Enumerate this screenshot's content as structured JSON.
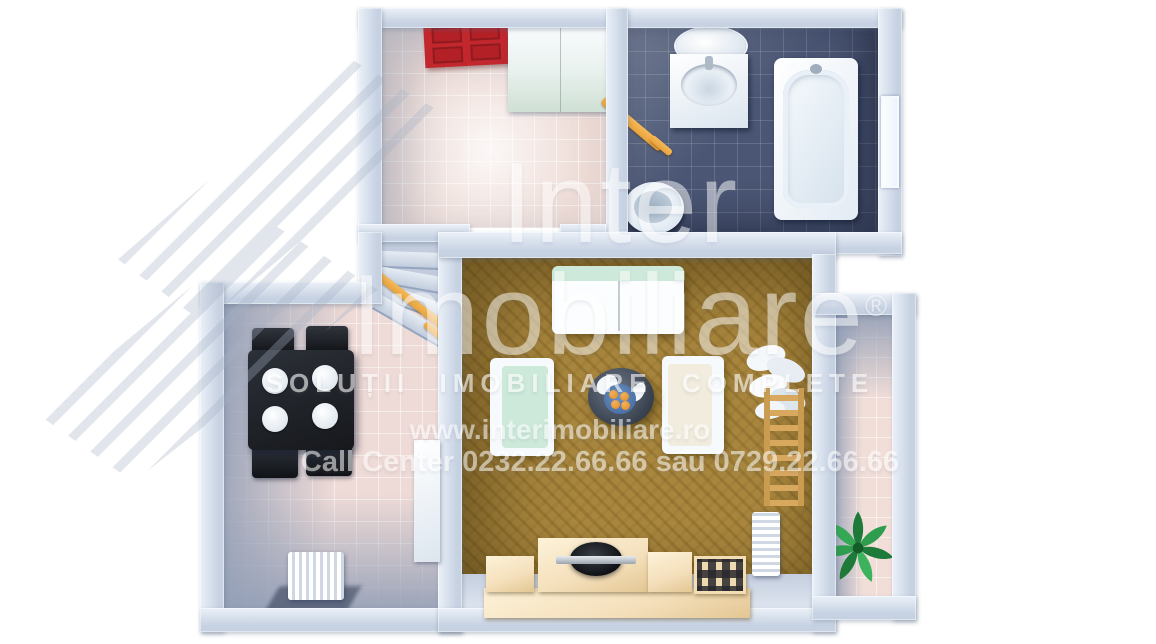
{
  "watermark": {
    "brand_top": "Inter",
    "brand_bottom": "Imobiliare",
    "registered": "®",
    "tagline": "SOLUȚII IMOBILIARE COMPLETE",
    "website": "www.interimobiliare.ro",
    "call_center": "Call Center 0232.22.66.66 sau 0729.22.66.66"
  },
  "colors": {
    "background": "#ffffff",
    "wall": "#c6d1e2",
    "wall_light": "#ebf1f8",
    "wall_shadow": "#93a5c0",
    "entry_floor": "#eddad4",
    "bathroom_floor": "#4a5674",
    "living_floor": "#a8863e",
    "dining_floor": "#eedad6",
    "hall_floor": "#c2ccdc",
    "balcony_floor": "#f2ded8",
    "door_red": "#c1272d",
    "accent_orange": "#e9a23b",
    "furniture_beige": "#f4dfba",
    "sofa_mint": "#cde9da",
    "table_black": "#16181c",
    "fixture_white": "#f7fafd",
    "plant_green": "#2e9e4e",
    "bowl_blue": "#4a6fa5",
    "fruit_orange": "#e08a28",
    "watermark": "#ffffff"
  }
}
